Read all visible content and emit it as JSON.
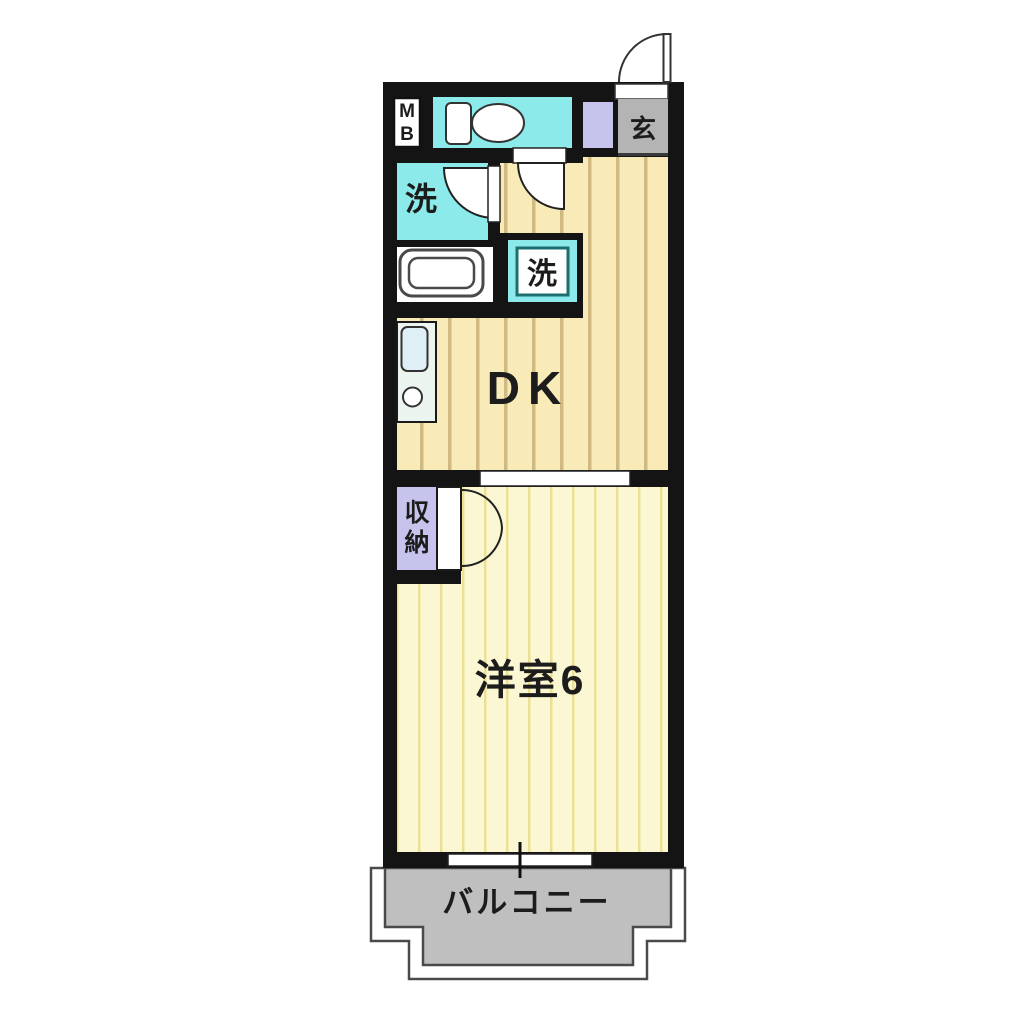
{
  "floorplan": {
    "labels": {
      "meter_box_m": "M",
      "meter_box_b": "B",
      "entrance": "玄",
      "washroom": "洗",
      "laundry": "洗",
      "dining_kitchen": "DK",
      "storage_char1": "収",
      "storage_char2": "納",
      "western_room": "洋室6",
      "balcony": "バルコニー"
    },
    "colors": {
      "wall": "#141414",
      "water_room_cyan": "#8deaea",
      "entrance_gray": "#b4b4b4",
      "balcony_gray": "#bfbfbf",
      "fixture_lavender": "#c6c3ec",
      "dk_floor": "#f8ebb8",
      "dk_stripe": "#d0ba82",
      "room_floor": "#fbf7d2",
      "room_stripe": "#ebe094",
      "kitchen_unit": "#ebf4ef",
      "sink_blue": "#dfeff6",
      "laundry_border": "#1d6e6e"
    }
  }
}
